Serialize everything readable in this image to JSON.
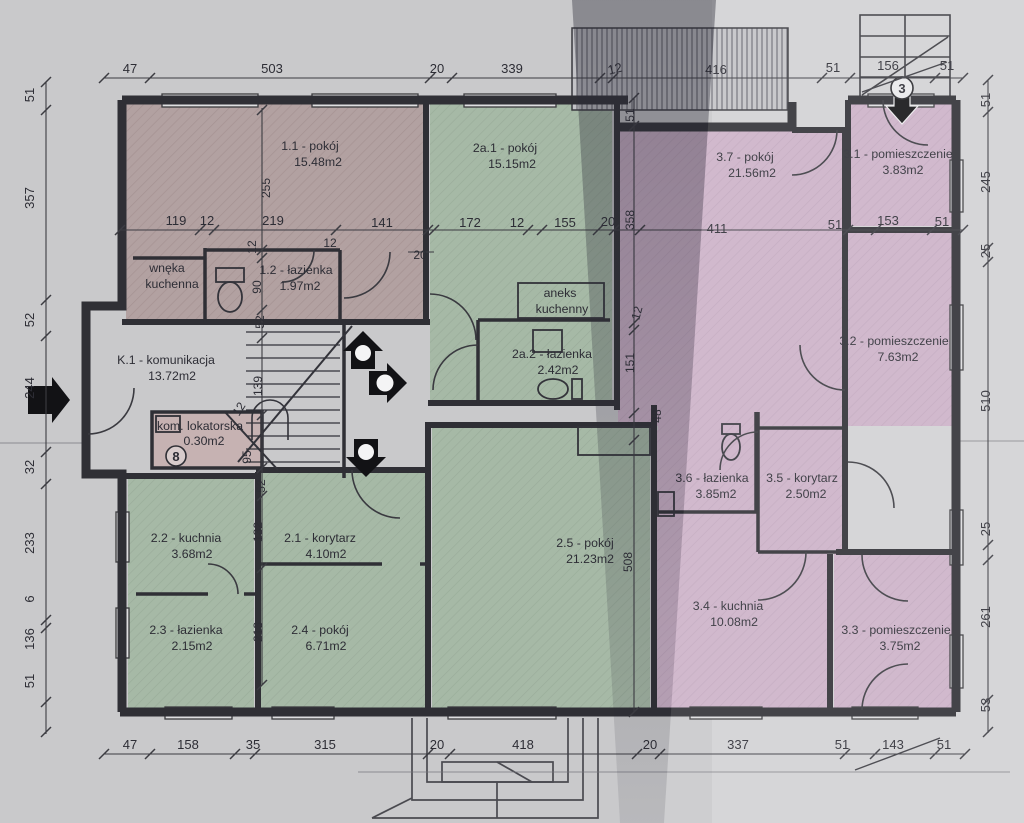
{
  "palette": {
    "paper": "#c9c9cb",
    "paper_right": "#d5d5d7",
    "room_rose": "#b2a1a1",
    "room_green": "#a6b9a6",
    "room_pink": "#ccb2c8",
    "room_storage": "#c6b2b2",
    "wall": "#2f2f35",
    "dim_line": "#3c3c42"
  },
  "rooms": [
    {
      "name": "1.1 - pokój",
      "area": "15.48m2"
    },
    {
      "name": "wnęka",
      "area": "kuchenna"
    },
    {
      "name": "1.2 - łazienka",
      "area": "1.97m2"
    },
    {
      "name": "2a.1 - pokój",
      "area": "15.15m2"
    },
    {
      "name": "aneks",
      "area": "kuchenny"
    },
    {
      "name": "2a.2 - łazienka",
      "area": "2.42m2"
    },
    {
      "name": "3.7 - pokój",
      "area": "21.56m2"
    },
    {
      "name": "3.1 - pomieszczenie",
      "area": "3.83m2"
    },
    {
      "name": "3.2 - pomieszczenie",
      "area": "7.63m2"
    },
    {
      "name": "3.6 - łazienka",
      "area": "3.85m2"
    },
    {
      "name": "3.5 - korytarz",
      "area": "2.50m2"
    },
    {
      "name": "3.4 - kuchnia",
      "area": "10.08m2"
    },
    {
      "name": "3.3 - pomieszczenie",
      "area": "3.75m2"
    },
    {
      "name": "K.1 - komunikacja",
      "area": "13.72m2"
    },
    {
      "name": "kom. lokatorska",
      "area": "0.30m2"
    },
    {
      "name": "2.2 - kuchnia",
      "area": "3.68m2"
    },
    {
      "name": "2.1 - korytarz",
      "area": "4.10m2"
    },
    {
      "name": "2.3 - łazienka",
      "area": "2.15m2"
    },
    {
      "name": "2.4 - pokój",
      "area": "6.71m2"
    },
    {
      "name": "2.5 - pokój",
      "area": "21.23m2"
    }
  ],
  "markers": {
    "exterior_stairs": "3",
    "tenant_meter": "8"
  },
  "dims": {
    "top": [
      "47",
      "503",
      "20",
      "339",
      "12",
      "416",
      "51",
      "156",
      "51"
    ],
    "mid": [
      "119",
      "12",
      "219",
      "141",
      "12",
      "172",
      "12",
      "155",
      "20",
      "20",
      "411",
      "51",
      "153",
      "51"
    ],
    "left": [
      "51",
      "357",
      "52",
      "244",
      "32",
      "233",
      "6",
      "136",
      "51"
    ],
    "right": [
      "51",
      "245",
      "25",
      "510",
      "25",
      "261",
      "53"
    ],
    "bottom": [
      "47",
      "158",
      "35",
      "315",
      "20",
      "418",
      "20",
      "337",
      "51",
      "143",
      "51"
    ],
    "stair_col": [
      "255",
      "12",
      "90",
      "52",
      "139",
      "12",
      "95",
      "52",
      "132",
      "213"
    ],
    "mid_col": [
      "51",
      "358",
      "12",
      "151",
      "48",
      "508"
    ]
  }
}
